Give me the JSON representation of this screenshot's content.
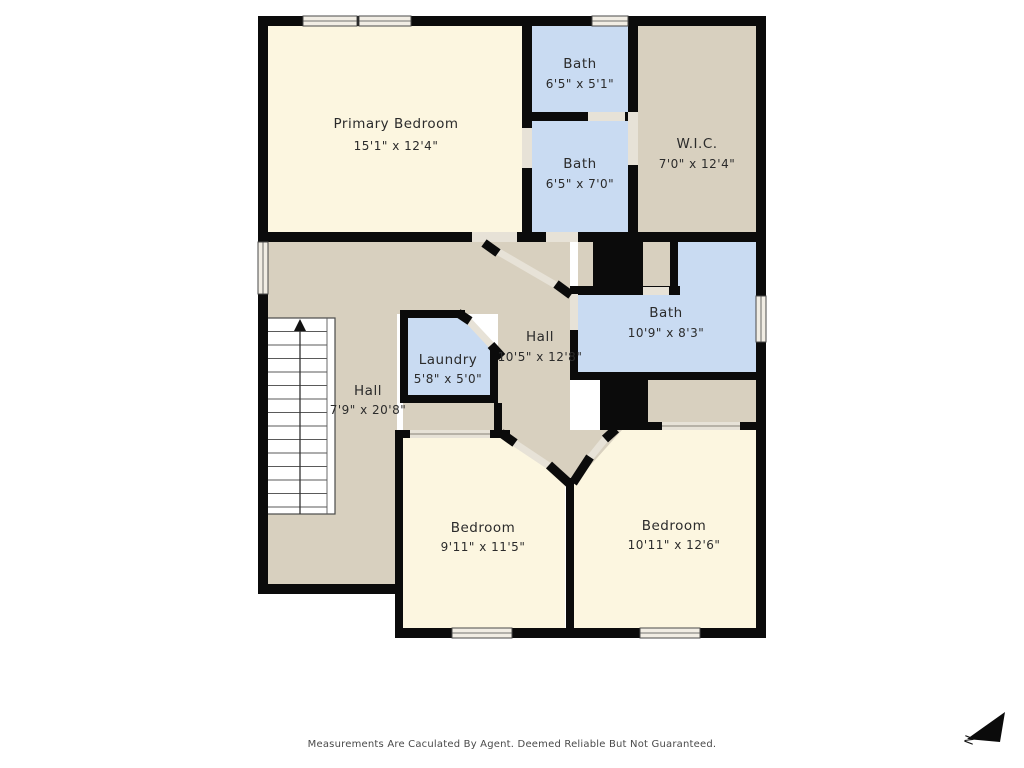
{
  "floorplan": {
    "rooms": {
      "primary_bedroom": {
        "name": "Primary Bedroom",
        "dims": "15'1\" x 12'4\""
      },
      "bath_top": {
        "name": "Bath",
        "dims": "6'5\" x 5'1\""
      },
      "bath_mid": {
        "name": "Bath",
        "dims": "6'5\" x 7'0\""
      },
      "wic": {
        "name": "W.I.C.",
        "dims": "7'0\" x 12'4\""
      },
      "hall_left": {
        "name": "Hall",
        "dims": "7'9\" x 20'8\""
      },
      "laundry": {
        "name": "Laundry",
        "dims": "5'8\" x 5'0\""
      },
      "hall_center": {
        "name": "Hall",
        "dims": "10'5\" x 12'8\""
      },
      "bath_right": {
        "name": "Bath",
        "dims": "10'9\" x 8'3\""
      },
      "bedroom_left": {
        "name": "Bedroom",
        "dims": "9'11\" x 11'5\""
      },
      "bedroom_right": {
        "name": "Bedroom",
        "dims": "10'11\" x 12'6\""
      }
    },
    "compass": {
      "letter": "N"
    },
    "footer_disclaimer": "Measurements Are Caculated By Agent. Deemed Reliable But Not Guaranteed.",
    "colors": {
      "room_cream": "#FCF6E0",
      "room_blue": "#C9DBF2",
      "room_tan": "#D8D0BF",
      "wall": "#0B0B0B",
      "opening": "#E7E2D7",
      "background": "#FFFFFF"
    }
  }
}
